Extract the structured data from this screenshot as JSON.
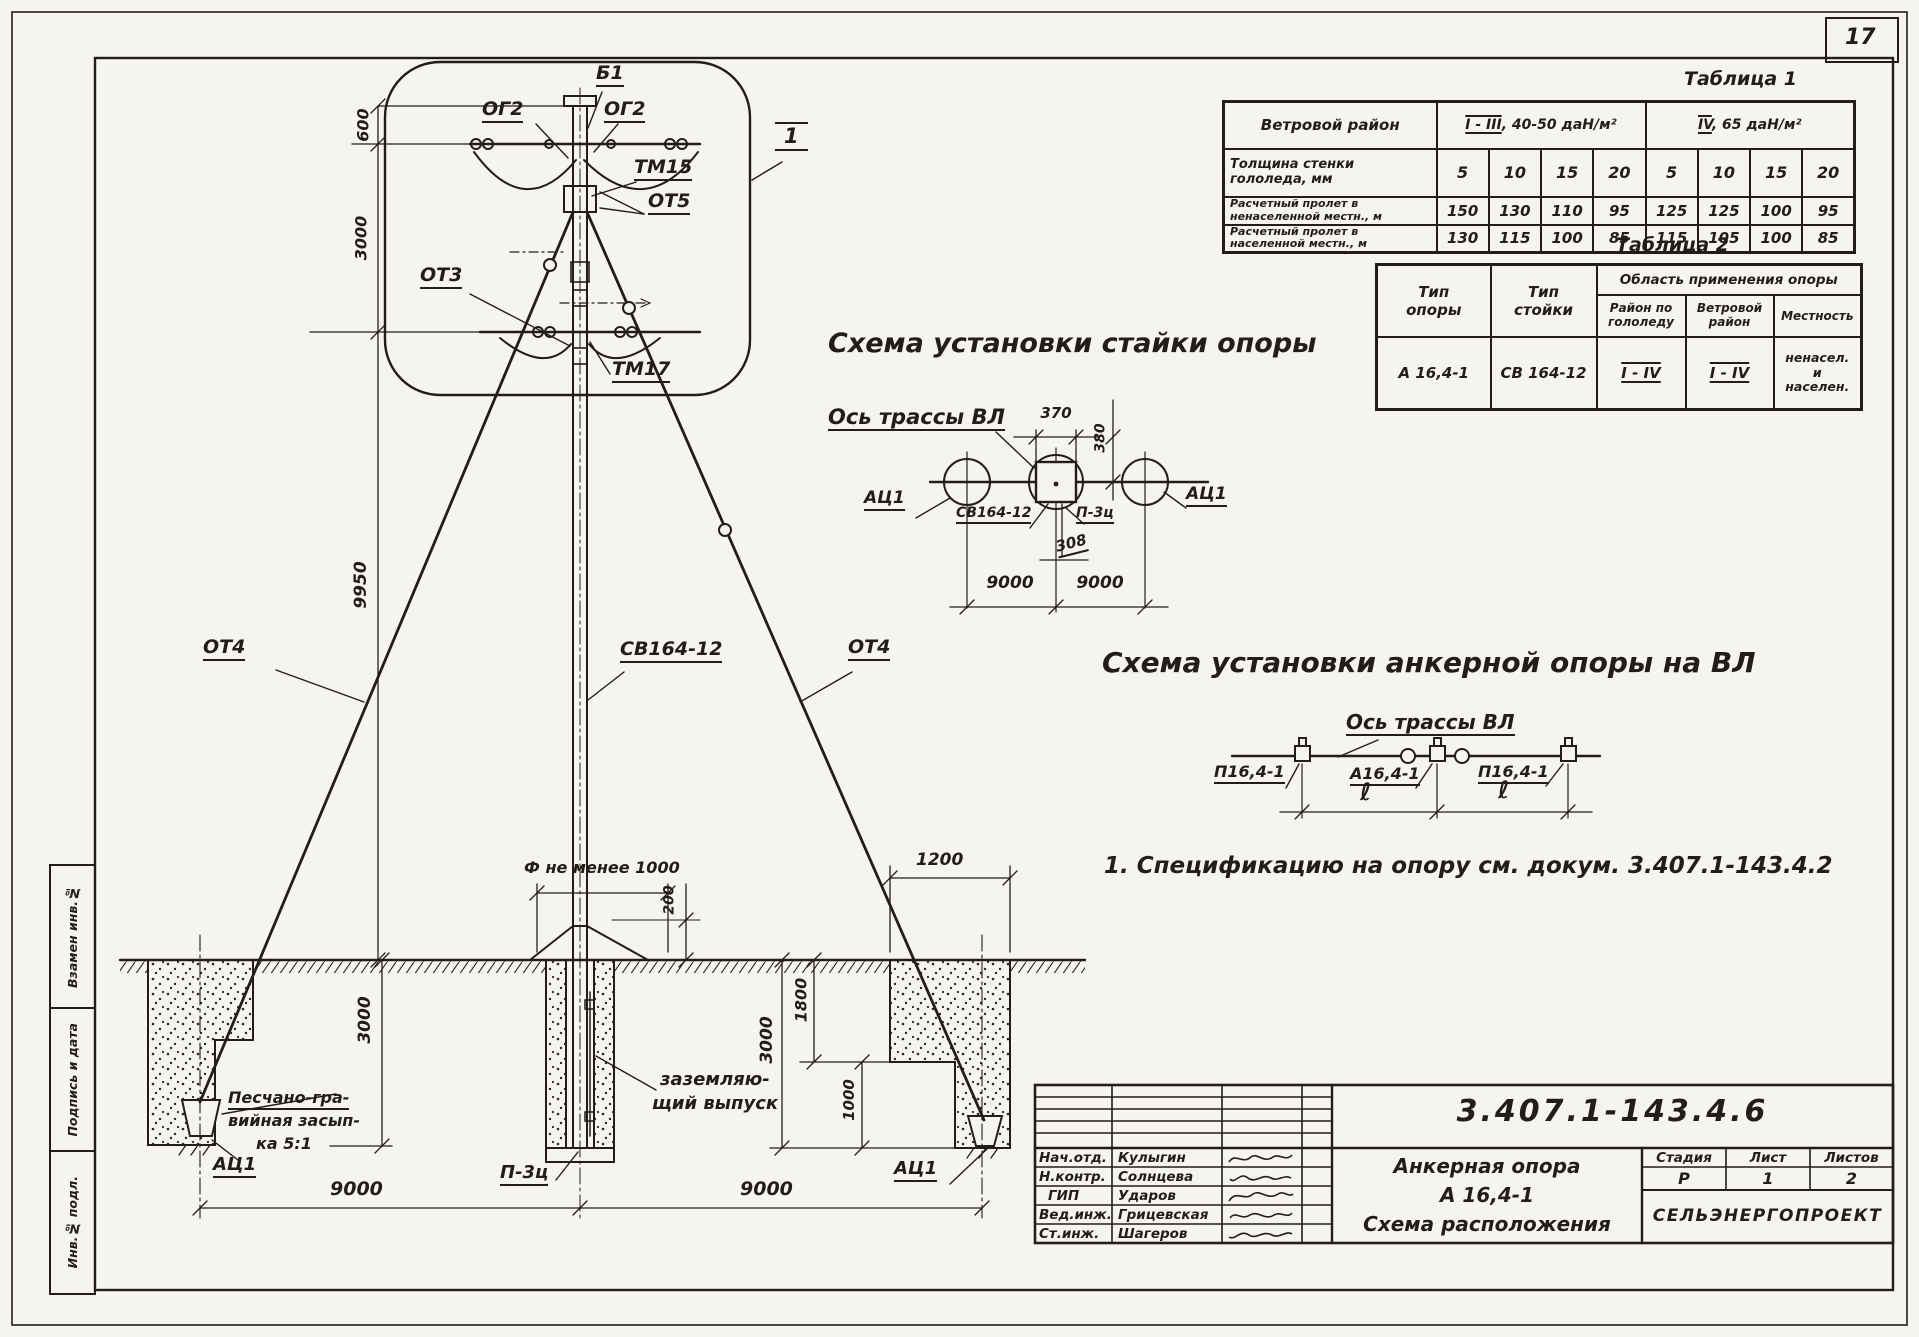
{
  "page": {
    "sheet_number": "17"
  },
  "stamp_column": {
    "cell_replaced_inv": "Взамен инв.№",
    "cell_sign_date": "Подпись и дата",
    "cell_inv_orig": "Инв.№ подл."
  },
  "pole_drawing": {
    "labels": {
      "b1": "Б1",
      "og2_left": "ОГ2",
      "og2_right": "ОГ2",
      "tm15": "ТМ15",
      "ot5": "ОТ5",
      "ot3": "ОТ3",
      "tm17": "ТМ17",
      "view_marker": "1",
      "ot4_left": "ОТ4",
      "stand": "СВ164-12",
      "ot4_right": "ОТ4",
      "anchor_left": "АЦ1",
      "anchor_right": "АЦ1",
      "pile": "П-3ц",
      "backfill_l1": "Песчано-гра-",
      "backfill_l2": "вийная засып-",
      "backfill_l3": "ка 5:1",
      "grounding_l1": "заземляю-",
      "grounding_l2": "щий выпуск",
      "diameter_note": "Ф не менее 1000"
    },
    "dims": {
      "top": "600",
      "upper": "3000",
      "pole": "9950",
      "cap": "200",
      "pit_left_depth": "3000",
      "pit_right_depth": "3000",
      "pit_right_upper": "1800",
      "pit_right_lower": "1000",
      "pit_right_width": "1200",
      "span_left": "9000",
      "span_right": "9000"
    }
  },
  "table1": {
    "caption": "Таблица 1",
    "wind_row_label": "Ветровой район",
    "wind_group1_range": "I - III",
    "wind_group1_rest": ", 40-50 даН/м²",
    "wind_group2_range": "IV",
    "wind_group2_rest": ",  65 даН/м²",
    "ice_label_l1": "Толщина  стенки",
    "ice_label_l2": "гололеда, мм",
    "ice_values": [
      "5",
      "10",
      "15",
      "20",
      "5",
      "10",
      "15",
      "20"
    ],
    "span1_label_l1": "Расчетный пролет в",
    "span1_label_l2": "ненаселенной местн., м",
    "span1_values": [
      "150",
      "130",
      "110",
      "95",
      "125",
      "125",
      "100",
      "95"
    ],
    "span2_label_l1": "Расчетный пролет в",
    "span2_label_l2": "населенной местн., м",
    "span2_values": [
      "130",
      "115",
      "100",
      "85",
      "115",
      "105",
      "100",
      "85"
    ]
  },
  "table2": {
    "caption": "Таблица 2",
    "col_pole_l1": "Тип",
    "col_pole_l2": "опоры",
    "col_stand_l1": "Тип",
    "col_stand_l2": "стойки",
    "area_header": "Область применения опоры",
    "sub_ice_l1": "Район по",
    "sub_ice_l2": "гололеду",
    "sub_wind_l1": "Ветровой",
    "sub_wind_l2": "район",
    "sub_terrain": "Местность",
    "row": {
      "pole_type": "А 16,4-1",
      "stand_type": "СВ 164-12",
      "ice": "I - IV",
      "wind": "I - IV",
      "terrain_l1": "ненасел.",
      "terrain_l2": "и",
      "terrain_l3": "населен."
    }
  },
  "scheme_stand": {
    "title": "Схема установки стайки опоры",
    "axis_label": "Ось трассы ВЛ",
    "anchor_left": "АЦ1",
    "stand": "СВ164-12",
    "pile": "П-3ц",
    "anchor_right": "АЦ1",
    "dims": {
      "width": "370",
      "height": "380",
      "offset": "308",
      "span_left": "9000",
      "span_right": "9000"
    }
  },
  "scheme_line": {
    "title": "Схема установки анкерной опоры на ВЛ",
    "axis_label": "Ось трассы ВЛ",
    "pole_left": "П16,4-1",
    "pole_mid": "А16,4-1",
    "pole_right": "П16,4-1",
    "span_left": "ℓ",
    "span_right": "ℓ"
  },
  "note": "1. Спецификацию  на опору см. докум. 3.407.1-143.4.2",
  "title_block": {
    "doc_number": "3.407.1-143.4.6",
    "rows": [
      {
        "role": "Нач.отд.",
        "name": "Кулыгин"
      },
      {
        "role": "Н.контр.",
        "name": "Солнцева"
      },
      {
        "role": "ГИП",
        "name": "Ударов"
      },
      {
        "role": "Вед.инж.",
        "name": "Грицевская"
      },
      {
        "role": "Ст.инж.",
        "name": "Шагеров"
      }
    ],
    "title_l1": "Анкерная  опора",
    "title_l2": "А 16,4-1",
    "title_l3": "Схема расположения",
    "stage_label": "Стадия",
    "sheet_label": "Лист",
    "sheets_label": "Листов",
    "stage": "Р",
    "sheet": "1",
    "sheets": "2",
    "organization": "СЕЛЬЭНЕРГОПРОЕКТ"
  }
}
